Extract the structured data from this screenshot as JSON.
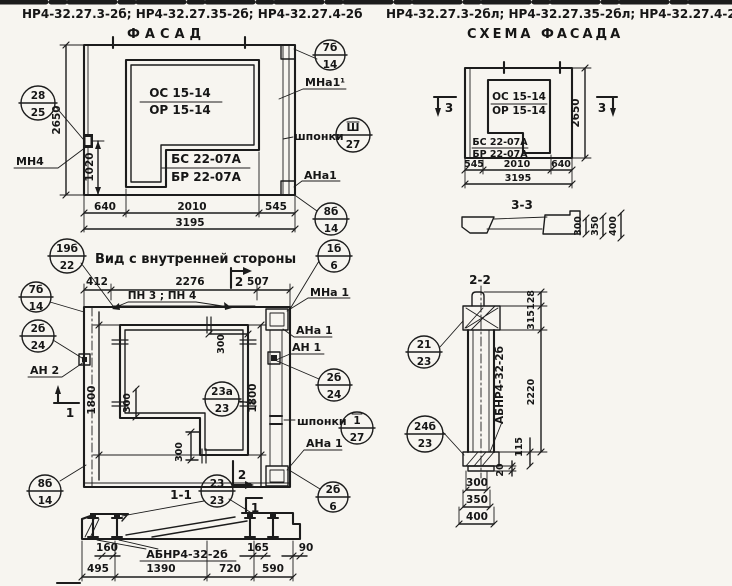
{
  "colors": {
    "ink": "#1c1c1c",
    "paper": "#f7f5f0"
  },
  "header": {
    "left_code": "НР4-32.27.3-2б; НР4-32.27.35-2б; НР4-32.27.4-2б",
    "left_title": "ФАСАД",
    "right_code": "НР4-32.27.3-2бл; НР4-32.27.35-2бл; НР4-32.27.4-2бл",
    "right_title": "СХЕМА ФАСАДА"
  },
  "facade": {
    "opening_labels": {
      "os": "ОС 15-14",
      "or": "ОР 15-14",
      "bs": "БС 22-07А",
      "br": "БР 22-07А"
    },
    "anchor_labels": {
      "mn4": "МН4",
      "mna1": "МНа1¹",
      "shponki": "шпонки",
      "ana1": "АНа1"
    },
    "dims": {
      "height": "2650",
      "anchor": "1020",
      "left": "640",
      "middle": "2010",
      "right": "545",
      "total": "3195"
    },
    "balloons": {
      "left": {
        "top": "28",
        "bottom": "25"
      },
      "top_right": {
        "top": "7б",
        "bottom": "14"
      },
      "keys": {
        "top": "Ш",
        "bottom": "27"
      },
      "bottom_right": {
        "top": "8б",
        "bottom": "14"
      }
    }
  },
  "scheme": {
    "opening_labels": {
      "os": "ОС 15-14",
      "or": "ОР 15-14",
      "bs": "БС 22-07А",
      "br": "БР 22-07А"
    },
    "dims": {
      "height": "2650",
      "left": "545",
      "middle": "2010",
      "right": "640",
      "total": "3195"
    },
    "section_mark": "3"
  },
  "section33": {
    "title": "3-3",
    "dims": {
      "a": "300",
      "b": "350",
      "c": "400"
    }
  },
  "inner": {
    "title": "Вид с внутренней стороны",
    "dims": {
      "left": "412",
      "middle": "2276",
      "right": "507",
      "height_left": "1800",
      "height_right": "1800",
      "top": "300",
      "side": "300",
      "step": "300"
    },
    "labels": {
      "pn": "ПН 3 ; ПН 4",
      "mna1": "МНа 1",
      "ana1_top": "АНа 1",
      "an1": "АН 1",
      "an2": "АН 2",
      "shponki": "шпонки",
      "ana1_bottom": "АНа 1"
    },
    "marks": {
      "cut1": "1",
      "cut2": "2"
    },
    "balloons": {
      "top_left": {
        "top": "19б",
        "bottom": "22"
      },
      "left_upper": {
        "top": "7б",
        "bottom": "14"
      },
      "left": {
        "top": "2б",
        "bottom": "24"
      },
      "top_right": {
        "top": "1б",
        "bottom": "6"
      },
      "right": {
        "top": "2б",
        "bottom": "24"
      },
      "keys": {
        "top": "1",
        "bottom": "27"
      },
      "opening": {
        "top": "23а",
        "bottom": "23"
      },
      "cut": {
        "top": "23",
        "bottom": "23"
      },
      "bottom_right": {
        "top": "2б",
        "bottom": "6"
      },
      "bottom_left": {
        "top": "8б",
        "bottom": "14"
      }
    }
  },
  "section11": {
    "title": "1-1",
    "label": "АБНР4-32-2б",
    "mark": "1",
    "dims": {
      "d160": "160",
      "d165": "165",
      "d90": "90",
      "d495": "495",
      "d1390": "1390",
      "d720": "720",
      "d590": "590"
    }
  },
  "section22": {
    "title": "2-2",
    "label": "АБНР4-32-2б",
    "dims": {
      "d128": "128",
      "d315": "315",
      "d2220": "2220",
      "d115": "115",
      "d20": "20",
      "d300": "300",
      "d350": "350",
      "d400": "400"
    },
    "balloons": {
      "top": {
        "top": "21",
        "bottom": "23"
      },
      "bottom": {
        "top": "24б",
        "bottom": "23"
      }
    }
  }
}
